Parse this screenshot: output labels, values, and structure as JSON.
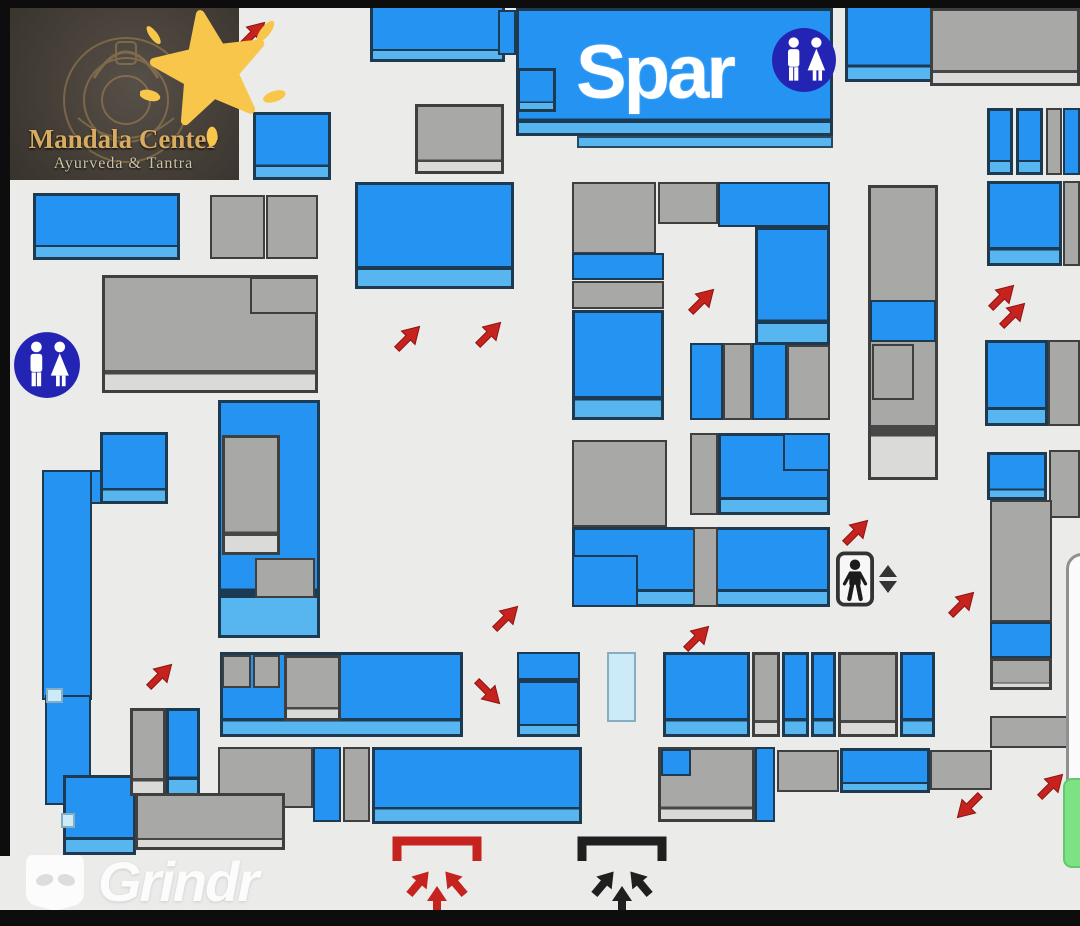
{
  "labels": {
    "spar": "Spar",
    "logo_title": "Mandala Center",
    "logo_subtitle": "Ayurveda & Tantra",
    "watermark": "Grindr"
  },
  "colors": {
    "background": "#ebebea",
    "store_blue": "#2493f2",
    "store_blue_band": "#57b5ef",
    "store_gray": "#a8a8a6",
    "store_gray_band": "#dadad8",
    "pale_blue": "#cdeaf8",
    "restroom_navy": "#2424b4",
    "arrow_red": "#c6231f",
    "entrance_black": "#1f1f1f",
    "floor_green": "#7de283",
    "star_gold": "#f7c64a",
    "frame_black": "#0d0d0d"
  },
  "icons": {
    "restroom": "restroom-icon",
    "elevator": "elevator-icon",
    "elevator_updown": "up-down-arrows-icon",
    "entrance": "entrance-arrows-icon",
    "star": "star-sticker-icon",
    "grindr_mask": "grindr-mask-icon",
    "direction": "red-direction-arrow-icon"
  },
  "map": {
    "blocks": [
      [
        370,
        5,
        135,
        57,
        "b"
      ],
      [
        845,
        4,
        88,
        78,
        "b"
      ],
      [
        930,
        8,
        150,
        78,
        "g"
      ],
      [
        253,
        112,
        78,
        68,
        "b"
      ],
      [
        415,
        104,
        89,
        70,
        "g"
      ],
      [
        355,
        182,
        159,
        107,
        "b"
      ],
      [
        498,
        10,
        18,
        45,
        "B"
      ],
      [
        517,
        68,
        39,
        44,
        "b"
      ],
      [
        577,
        136,
        256,
        12,
        "L"
      ],
      [
        987,
        108,
        26,
        67,
        "b"
      ],
      [
        1016,
        108,
        27,
        67,
        "b"
      ],
      [
        1046,
        108,
        16,
        67,
        "G"
      ],
      [
        1063,
        108,
        17,
        67,
        "B"
      ],
      [
        987,
        181,
        75,
        85,
        "b"
      ],
      [
        1063,
        181,
        17,
        85,
        "G"
      ],
      [
        33,
        193,
        147,
        67,
        "b"
      ],
      [
        210,
        195,
        55,
        64,
        "G"
      ],
      [
        266,
        195,
        52,
        64,
        "G"
      ],
      [
        102,
        275,
        216,
        118,
        "g"
      ],
      [
        250,
        277,
        68,
        37,
        "G"
      ],
      [
        572,
        182,
        84,
        72,
        "G"
      ],
      [
        658,
        182,
        60,
        42,
        "G"
      ],
      [
        718,
        182,
        112,
        45,
        "B"
      ],
      [
        755,
        227,
        75,
        118,
        "b"
      ],
      [
        572,
        253,
        92,
        27,
        "B"
      ],
      [
        572,
        281,
        92,
        28,
        "G"
      ],
      [
        572,
        310,
        92,
        110,
        "b"
      ],
      [
        690,
        343,
        33,
        77,
        "B"
      ],
      [
        723,
        343,
        29,
        77,
        "G"
      ],
      [
        752,
        343,
        35,
        77,
        "B"
      ],
      [
        787,
        345,
        43,
        75,
        "G"
      ],
      [
        868,
        185,
        70,
        295,
        "g"
      ],
      [
        870,
        300,
        66,
        42,
        "B"
      ],
      [
        872,
        344,
        42,
        56,
        "G"
      ],
      [
        985,
        340,
        63,
        86,
        "b"
      ],
      [
        1048,
        340,
        32,
        86,
        "G"
      ],
      [
        987,
        452,
        60,
        48,
        "b"
      ],
      [
        1049,
        450,
        31,
        68,
        "G"
      ],
      [
        990,
        500,
        62,
        122,
        "G"
      ],
      [
        990,
        622,
        62,
        36,
        "B"
      ],
      [
        990,
        658,
        62,
        32,
        "g"
      ],
      [
        572,
        440,
        95,
        87,
        "G"
      ],
      [
        690,
        433,
        28,
        82,
        "G"
      ],
      [
        718,
        433,
        112,
        82,
        "b"
      ],
      [
        783,
        433,
        47,
        38,
        "B"
      ],
      [
        572,
        527,
        258,
        80,
        "b"
      ],
      [
        693,
        527,
        25,
        80,
        "G"
      ],
      [
        572,
        555,
        66,
        52,
        "B"
      ],
      [
        218,
        400,
        102,
        238,
        "b"
      ],
      [
        222,
        435,
        58,
        120,
        "g"
      ],
      [
        255,
        558,
        60,
        40,
        "G"
      ],
      [
        42,
        470,
        126,
        34,
        "B"
      ],
      [
        42,
        470,
        50,
        230,
        "B"
      ],
      [
        45,
        695,
        46,
        110,
        "B"
      ],
      [
        63,
        775,
        73,
        80,
        "b"
      ],
      [
        100,
        432,
        68,
        72,
        "b"
      ],
      [
        46,
        688,
        17,
        15,
        "p"
      ],
      [
        61,
        813,
        14,
        15,
        "p"
      ],
      [
        130,
        708,
        36,
        88,
        "g"
      ],
      [
        166,
        708,
        34,
        88,
        "b"
      ],
      [
        220,
        652,
        243,
        85,
        "b"
      ],
      [
        222,
        655,
        29,
        33,
        "G"
      ],
      [
        253,
        655,
        27,
        33,
        "G"
      ],
      [
        284,
        655,
        57,
        66,
        "g"
      ],
      [
        517,
        652,
        63,
        28,
        "B"
      ],
      [
        517,
        680,
        63,
        57,
        "b"
      ],
      [
        607,
        652,
        29,
        70,
        "p"
      ],
      [
        663,
        652,
        87,
        85,
        "b"
      ],
      [
        752,
        652,
        28,
        85,
        "g"
      ],
      [
        782,
        652,
        27,
        85,
        "b"
      ],
      [
        811,
        652,
        25,
        85,
        "b"
      ],
      [
        838,
        652,
        60,
        85,
        "g"
      ],
      [
        900,
        652,
        35,
        85,
        "b"
      ],
      [
        218,
        747,
        95,
        61,
        "G"
      ],
      [
        135,
        793,
        150,
        57,
        "g"
      ],
      [
        313,
        747,
        28,
        75,
        "B"
      ],
      [
        343,
        747,
        27,
        75,
        "G"
      ],
      [
        372,
        747,
        210,
        77,
        "b"
      ],
      [
        658,
        747,
        97,
        75,
        "g"
      ],
      [
        661,
        749,
        30,
        27,
        "B"
      ],
      [
        755,
        747,
        20,
        75,
        "B"
      ],
      [
        777,
        750,
        62,
        42,
        "G"
      ],
      [
        840,
        748,
        90,
        45,
        "b"
      ],
      [
        930,
        750,
        62,
        40,
        "G"
      ],
      [
        990,
        716,
        90,
        32,
        "G"
      ],
      [
        1074,
        585,
        8,
        36,
        "B"
      ]
    ],
    "arrows": [
      [
        253,
        33,
        -45
      ],
      [
        408,
        337,
        -45
      ],
      [
        489,
        333,
        -45
      ],
      [
        702,
        300,
        -45
      ],
      [
        160,
        675,
        -45
      ],
      [
        506,
        617,
        -45
      ],
      [
        488,
        693,
        45
      ],
      [
        697,
        637,
        -45
      ],
      [
        856,
        531,
        -45
      ],
      [
        962,
        603,
        -45
      ],
      [
        1002,
        296,
        -45
      ],
      [
        1013,
        314,
        -45
      ],
      [
        967,
        807,
        135
      ],
      [
        1051,
        785,
        -45
      ]
    ],
    "restrooms": [
      {
        "x": 771,
        "y": 27,
        "d": 66
      },
      {
        "x": 13,
        "y": 331,
        "d": 68
      }
    ],
    "elevator": {
      "x": 836,
      "y": 551
    },
    "entrances": [
      {
        "x": 391,
        "y": 833,
        "kind": "red"
      },
      {
        "x": 576,
        "y": 833,
        "kind": "black"
      }
    ],
    "floor_indicator": {
      "x": 1063,
      "y": 778,
      "w": 26,
      "h": 90
    }
  }
}
